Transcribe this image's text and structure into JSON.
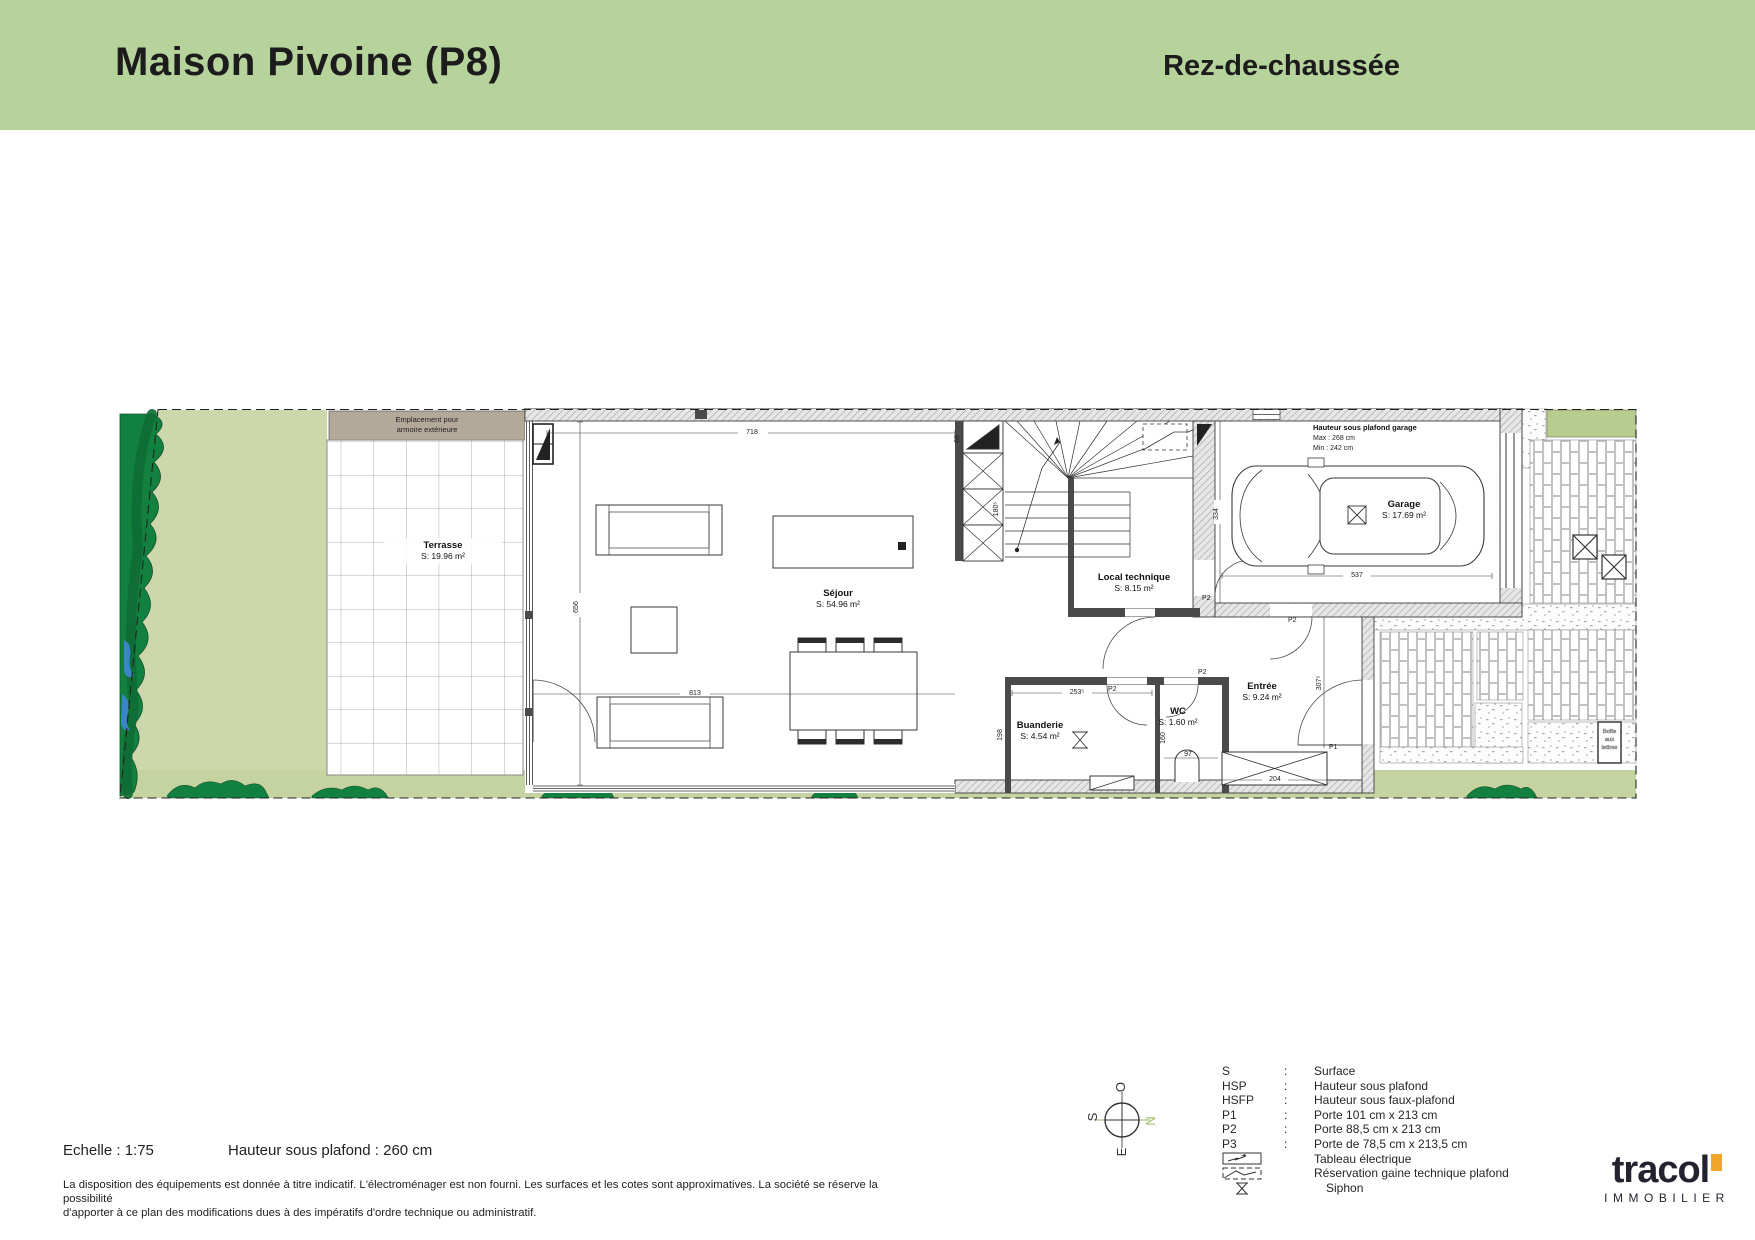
{
  "header": {
    "title": "Maison Pivoine (P8)",
    "subtitle": "Rez-de-chaussée"
  },
  "plan": {
    "rooms": {
      "jardin": {
        "name": "Jardin",
        "area": "S: 24.57 m²"
      },
      "terrasse": {
        "name": "Terrasse",
        "area": "S: 19.96 m²"
      },
      "sejour": {
        "name": "Séjour",
        "area": "S: 54.96 m²"
      },
      "local_technique": {
        "name": "Local technique",
        "area": "S: 8.15 m²"
      },
      "garage": {
        "name": "Garage",
        "area": "S: 17.69 m²"
      },
      "entree": {
        "name": "Entrée",
        "area": "S: 9.24 m²"
      },
      "wc": {
        "name": "WC",
        "area": "S: 1.60 m²"
      },
      "buanderie": {
        "name": "Buanderie",
        "area": "S: 4.54 m²"
      }
    },
    "notes": {
      "armoire_line1": "Emplacement pour",
      "armoire_line2": "armoire extérieure",
      "garage_hsp_title": "Hauteur sous plafond garage",
      "garage_hsp_max": "Max : 268 cm",
      "garage_hsp_min": "Min : 242 cm",
      "boite_line1": "Boîte",
      "boite_line2": "aux",
      "boite_line3": "lettres"
    },
    "dims": {
      "sejour_w": "718",
      "sejour_h": "656",
      "sejour_w2": "813",
      "stair_box": "65",
      "stair_w": "180⁵",
      "garage_h": "334",
      "garage_w": "537",
      "buanderie_w": "253⁵",
      "buanderie_h": "198",
      "wc_h": "160",
      "wc_w": "97",
      "mat_w": "204",
      "entree_h": "307⁵"
    },
    "doors": {
      "p1": "P1",
      "p2": "P2"
    }
  },
  "compass": {
    "n": "N",
    "s": "S",
    "e": "E",
    "o": "O",
    "north_color": "#9cba68"
  },
  "legend": {
    "rows": [
      {
        "term": "S",
        "sep": ":",
        "desc": "Surface"
      },
      {
        "term": "HSP",
        "sep": ":",
        "desc": "Hauteur sous plafond"
      },
      {
        "term": "HSFP",
        "sep": ":",
        "desc": "Hauteur sous faux-plafond"
      },
      {
        "term": "P1",
        "sep": ":",
        "desc": "Porte 101 cm x 213 cm"
      },
      {
        "term": "P2",
        "sep": ":",
        "desc": "Porte 88,5 cm x 213 cm"
      },
      {
        "term": "P3",
        "sep": ":",
        "desc": "Porte de 78,5 cm x 213,5 cm"
      }
    ],
    "icons": [
      {
        "icon": "tableau-electrique-icon",
        "desc": "Tableau électrique"
      },
      {
        "icon": "gaine-technique-icon",
        "desc": "Réservation gaine technique plafond"
      },
      {
        "icon": "siphon-icon",
        "desc": "Siphon"
      }
    ]
  },
  "footer": {
    "scale": "Echelle : 1:75",
    "hsp": "Hauteur sous plafond : 260 cm",
    "disclaimer_line1": "La disposition des équipements est donnée à titre indicatif. L'électroménager est non fourni. Les surfaces et les cotes sont approximatives. La société se réserve la possibilité",
    "disclaimer_line2": "d'apporter à ce plan des modifications dues à des impératifs d'ordre technique ou administratif."
  },
  "logo": {
    "name": "tracol",
    "sub": "IMMOBILIER"
  },
  "colors": {
    "header_green": "#b6d39c",
    "garden": "#ccd8ab",
    "tree": "#12813f",
    "accent_orange": "#f0a62a"
  }
}
